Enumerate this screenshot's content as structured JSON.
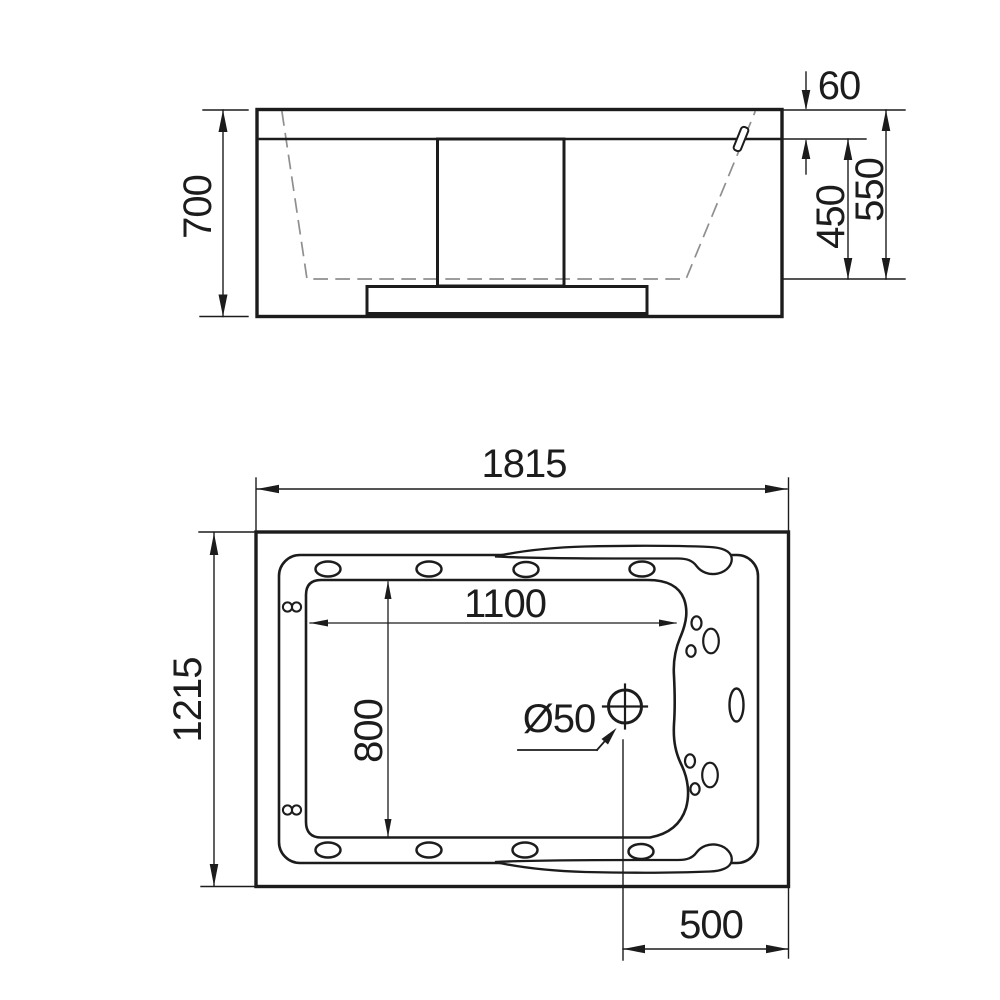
{
  "drawing": {
    "type": "bathtub technical drawing, two orthographic views",
    "background": "#ffffff",
    "line_color": "#1c1c1c",
    "dashed_color": "#8f8f8f",
    "front_view": {
      "title": "front-elevation",
      "overall_height": "700",
      "rim_thickness": "60",
      "inner_depth": "450",
      "shell_height": "550"
    },
    "plan_view": {
      "title": "top-plan",
      "overall_length": "1815",
      "overall_width": "1215",
      "floor_length": "1100",
      "floor_width": "800",
      "drain_diameter": "Ø50",
      "drain_offset": "500"
    }
  }
}
